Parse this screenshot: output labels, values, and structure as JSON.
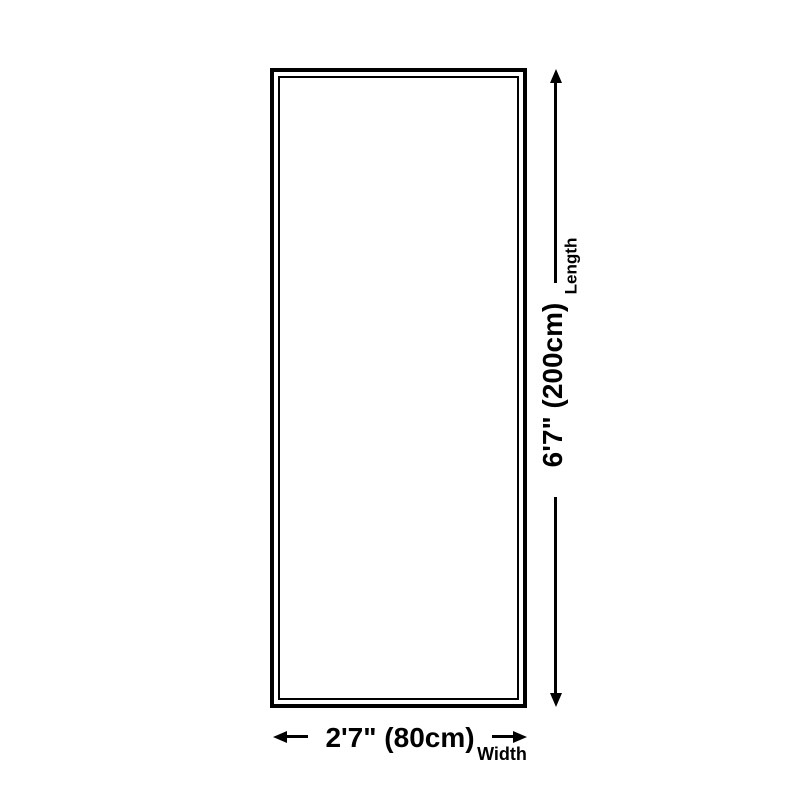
{
  "diagram": {
    "length_dimension": {
      "value": "6'7\" (200cm)",
      "label": "Length"
    },
    "width_dimension": {
      "value": "2'7\" (80cm)",
      "label": "Width"
    },
    "colors": {
      "background": "#ffffff",
      "line": "#000000"
    }
  }
}
